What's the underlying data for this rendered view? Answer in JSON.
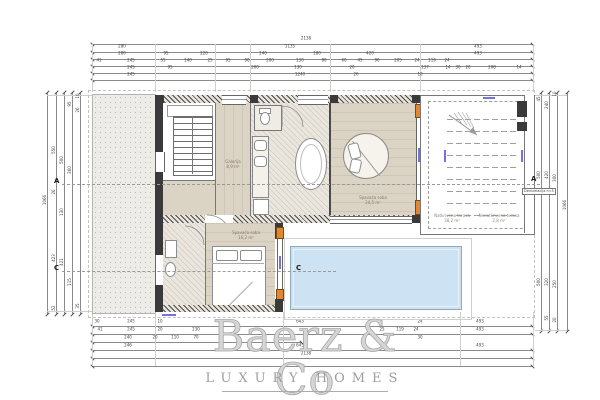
{
  "watermark": {
    "title": "Baerz & Co",
    "subtitle": "LUXURY HOMES"
  },
  "rooms": {
    "master_bedroom": {
      "label": "Spavaća soba",
      "area": "24,5 m²"
    },
    "bedroom2": {
      "label": "Spavaća soba",
      "area": "16,2 m²"
    },
    "gallery": {
      "label": "Galerija",
      "area": "8,9 m²"
    },
    "covered_terrace": {
      "label": "Natkrivena terasa",
      "area": "38,2 m²"
    },
    "open_terrace": {
      "label": "Nenatkrivena terasa",
      "area": "2,8 m²"
    }
  },
  "markers": {
    "section_a_left": "A",
    "section_a_right": "A",
    "section_c_left": "C",
    "section_c_pool": "C",
    "level_note": "Denivelacija h=5"
  },
  "colors": {
    "floor": "#dbd3c4",
    "pool": "#cde3f4",
    "jamb": "#e2872f",
    "wall": "#3a3a3a",
    "watermark": "#a6a6a6",
    "door_label_blue": "#5b5bd9"
  },
  "dims": {
    "top": [
      {
        "t": "2138",
        "x": 306,
        "y": 41
      },
      {
        "t": "280",
        "x": 122,
        "y": 49
      },
      {
        "t": "1135",
        "x": 290,
        "y": 49
      },
      {
        "t": "493",
        "x": 478,
        "y": 49
      },
      {
        "t": "280",
        "x": 122,
        "y": 56
      },
      {
        "t": "95",
        "x": 166,
        "y": 56
      },
      {
        "t": "220",
        "x": 204,
        "y": 56
      },
      {
        "t": "240",
        "x": 263,
        "y": 56
      },
      {
        "t": "180",
        "x": 317,
        "y": 56
      },
      {
        "t": "420",
        "x": 370,
        "y": 56
      },
      {
        "t": "493",
        "x": 478,
        "y": 56
      },
      {
        "t": "41",
        "x": 99,
        "y": 63
      },
      {
        "t": "245",
        "x": 131,
        "y": 63
      },
      {
        "t": "55",
        "x": 163,
        "y": 63
      },
      {
        "t": "140",
        "x": 188,
        "y": 63
      },
      {
        "t": "25",
        "x": 210,
        "y": 63
      },
      {
        "t": "95",
        "x": 228,
        "y": 63
      },
      {
        "t": "90",
        "x": 247,
        "y": 63
      },
      {
        "t": "200",
        "x": 270,
        "y": 63
      },
      {
        "t": "130",
        "x": 300,
        "y": 63
      },
      {
        "t": "80",
        "x": 324,
        "y": 63
      },
      {
        "t": "60",
        "x": 344,
        "y": 63
      },
      {
        "t": "45",
        "x": 360,
        "y": 63
      },
      {
        "t": "90",
        "x": 377,
        "y": 63
      },
      {
        "t": "205",
        "x": 398,
        "y": 63
      },
      {
        "t": "24",
        "x": 417,
        "y": 63
      },
      {
        "t": "119",
        "x": 432,
        "y": 63
      },
      {
        "t": "24",
        "x": 447,
        "y": 63
      },
      {
        "t": "245",
        "x": 131,
        "y": 70
      },
      {
        "t": "95",
        "x": 170,
        "y": 70
      },
      {
        "t": "200",
        "x": 255,
        "y": 70
      },
      {
        "t": "130",
        "x": 298,
        "y": 70
      },
      {
        "t": "20",
        "x": 352,
        "y": 70
      },
      {
        "t": "137",
        "x": 425,
        "y": 70
      },
      {
        "t": "14",
        "x": 448,
        "y": 70
      },
      {
        "t": "30",
        "x": 458,
        "y": 70
      },
      {
        "t": "20",
        "x": 468,
        "y": 70
      },
      {
        "t": "208",
        "x": 492,
        "y": 70
      },
      {
        "t": "14",
        "x": 519,
        "y": 70
      },
      {
        "t": "245",
        "x": 131,
        "y": 77
      },
      {
        "t": "1240",
        "x": 300,
        "y": 77
      },
      {
        "t": "26",
        "x": 356,
        "y": 77
      },
      {
        "t": "10",
        "x": 420,
        "y": 77
      }
    ],
    "bottom": [
      {
        "t": "30",
        "x": 97,
        "y": 324
      },
      {
        "t": "245",
        "x": 131,
        "y": 324
      },
      {
        "t": "10",
        "x": 160,
        "y": 324
      },
      {
        "t": "643",
        "x": 300,
        "y": 324
      },
      {
        "t": "24",
        "x": 420,
        "y": 324
      },
      {
        "t": "493",
        "x": 480,
        "y": 324
      },
      {
        "t": "41",
        "x": 100,
        "y": 332
      },
      {
        "t": "245",
        "x": 131,
        "y": 332
      },
      {
        "t": "20",
        "x": 160,
        "y": 332
      },
      {
        "t": "230",
        "x": 196,
        "y": 332
      },
      {
        "t": "25",
        "x": 382,
        "y": 332
      },
      {
        "t": "119",
        "x": 400,
        "y": 332
      },
      {
        "t": "24",
        "x": 416,
        "y": 332
      },
      {
        "t": "493",
        "x": 480,
        "y": 332
      },
      {
        "t": "240",
        "x": 128,
        "y": 340
      },
      {
        "t": "20",
        "x": 155,
        "y": 340
      },
      {
        "t": "110",
        "x": 175,
        "y": 340
      },
      {
        "t": "70",
        "x": 196,
        "y": 340
      },
      {
        "t": "30",
        "x": 420,
        "y": 340
      },
      {
        "t": "246",
        "x": 128,
        "y": 348
      },
      {
        "t": "645",
        "x": 300,
        "y": 348
      },
      {
        "t": "493",
        "x": 480,
        "y": 348
      },
      {
        "t": "2138",
        "x": 306,
        "y": 356
      }
    ],
    "left": [
      {
        "t": "1066",
        "x": 45,
        "y": 200,
        "r": 1
      },
      {
        "t": "550",
        "x": 54,
        "y": 150,
        "r": 1
      },
      {
        "t": "26",
        "x": 54,
        "y": 192,
        "r": 1
      },
      {
        "t": "423",
        "x": 54,
        "y": 258,
        "r": 1
      },
      {
        "t": "52",
        "x": 54,
        "y": 308,
        "r": 1
      },
      {
        "t": "500",
        "x": 62,
        "y": 160,
        "r": 1
      },
      {
        "t": "130",
        "x": 62,
        "y": 212,
        "r": 1
      },
      {
        "t": "421",
        "x": 62,
        "y": 262,
        "r": 1
      },
      {
        "t": "95",
        "x": 70,
        "y": 104,
        "r": 1
      },
      {
        "t": "360",
        "x": 70,
        "y": 170,
        "r": 1
      },
      {
        "t": "115",
        "x": 70,
        "y": 282,
        "r": 1
      },
      {
        "t": "10",
        "x": 78,
        "y": 96,
        "r": 1
      },
      {
        "t": "26",
        "x": 78,
        "y": 110,
        "r": 1
      },
      {
        "t": "35",
        "x": 78,
        "y": 306,
        "r": 1
      }
    ],
    "right": [
      {
        "t": "45",
        "x": 539,
        "y": 99,
        "r": 1
      },
      {
        "t": "500",
        "x": 539,
        "y": 175,
        "r": 1
      },
      {
        "t": "500",
        "x": 539,
        "y": 282,
        "r": 1
      },
      {
        "t": "240",
        "x": 547,
        "y": 105,
        "r": 1
      },
      {
        "t": "420",
        "x": 547,
        "y": 175,
        "r": 1
      },
      {
        "t": "320",
        "x": 547,
        "y": 282,
        "r": 1
      },
      {
        "t": "55",
        "x": 547,
        "y": 318,
        "r": 1
      },
      {
        "t": "10",
        "x": 555,
        "y": 94,
        "r": 1
      },
      {
        "t": "300",
        "x": 555,
        "y": 178,
        "r": 1
      },
      {
        "t": "250",
        "x": 555,
        "y": 284,
        "r": 1
      },
      {
        "t": "20",
        "x": 555,
        "y": 320,
        "r": 1
      },
      {
        "t": "1066",
        "x": 565,
        "y": 205,
        "r": 1
      }
    ]
  }
}
